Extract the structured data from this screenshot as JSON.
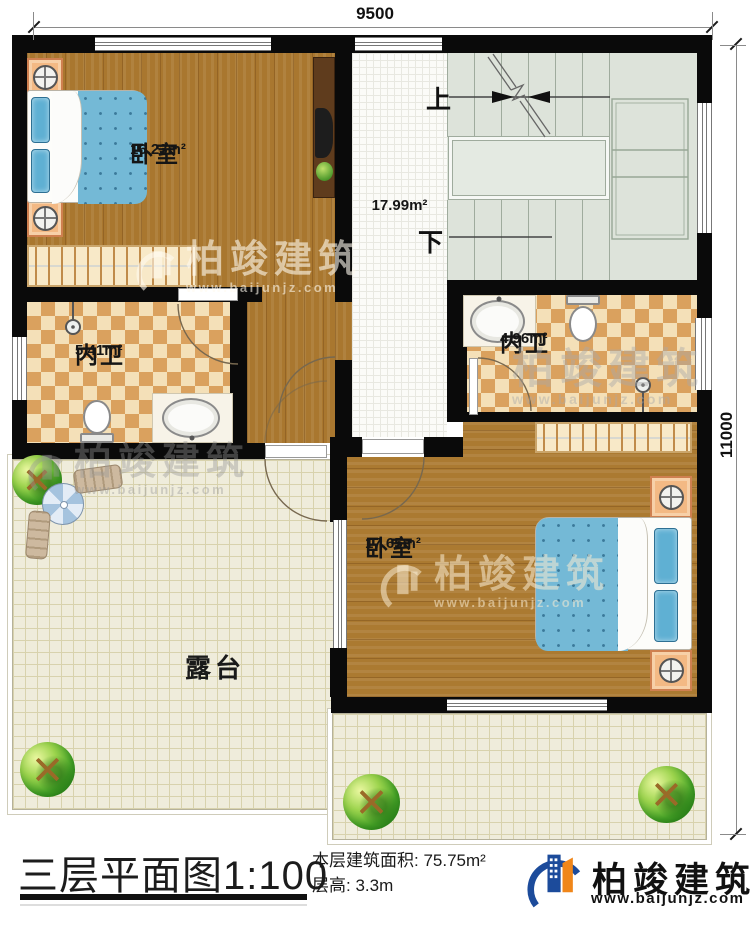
{
  "dimensions": {
    "top": "9500",
    "right": "11000"
  },
  "rooms": {
    "bedroom_top": {
      "name": "卧室",
      "area": "16.23m²"
    },
    "hall": {
      "area": "17.99m²"
    },
    "bathroom_left": {
      "name": "内卫",
      "area": "5.41m²"
    },
    "bathroom_right": {
      "name": "内卫",
      "area": "4.96m²"
    },
    "bedroom_bottom": {
      "name": "卧室",
      "area": "17.65m²"
    },
    "terrace": {
      "name": "露台"
    }
  },
  "stairs": {
    "up_label": "上",
    "down_label": "下"
  },
  "title_block": {
    "title": "三层平面图1:100",
    "area_label": "本层建筑面积:",
    "area_value": "75.75m²",
    "height_label": "层高:",
    "height_value": "3.3m"
  },
  "brand": {
    "name": "柏竣建筑",
    "website": "www.baijunjz.com"
  },
  "watermark": {
    "name": "柏竣建筑",
    "website": "www.baijunjz.com"
  },
  "colors": {
    "wall": "#0a0a0a",
    "wood": "#a9772f",
    "checker_tile": "#daa15e",
    "bed_blue": "#74b9d6",
    "terrace": "#efecdb",
    "logo_blue": "#1c4b9b",
    "logo_orange": "#f08619"
  }
}
